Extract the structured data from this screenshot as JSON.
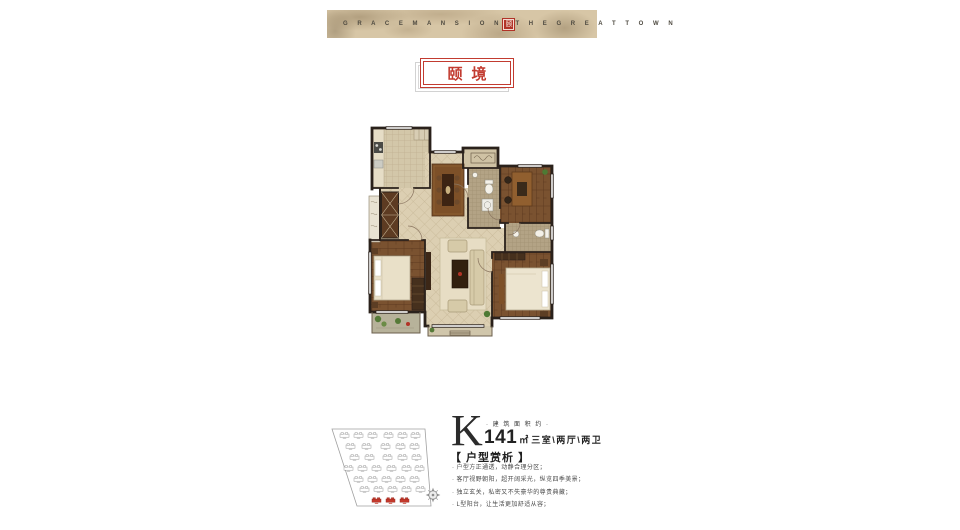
{
  "banner": {
    "left_text": "G R A C E M A N S I O N",
    "seal_char": "颐",
    "right_text": "T H E G R E A T T O W N"
  },
  "title": {
    "text": "颐境"
  },
  "unit": {
    "letter": "K",
    "area_label": "· 建 筑 面 积 约 ·",
    "area_value": "141",
    "area_unit": "㎡",
    "rooms": "三室\\两厅\\两卫"
  },
  "analysis": {
    "heading": "【 户型赏析 】",
    "points": [
      "· 户型方正通透，动静合理分区；",
      "· 客厅视野朝阳，超开阔采光，纵览四季美景；",
      "· 独立玄关，私密又不失豪华的尊贵典藏；",
      "· L型阳台，让生活更加舒适从容；"
    ]
  },
  "icons": {
    "compass": "compass-rose",
    "seal": "red-seal-stamp"
  },
  "colors": {
    "accent_red": "#c23b30",
    "wall": "#2a211b",
    "banner_paper": "#d7c6a6"
  }
}
